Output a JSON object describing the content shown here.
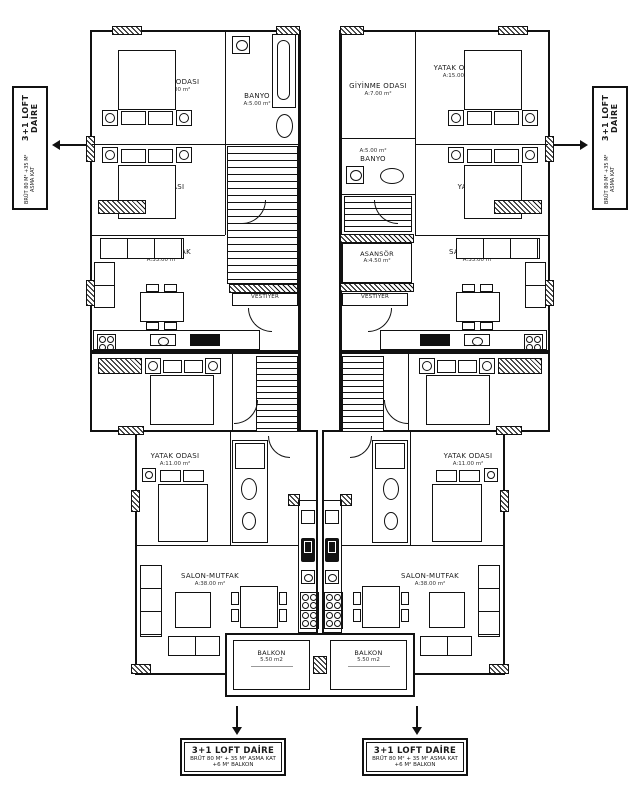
{
  "plan": {
    "upper_left": {
      "bedroom_a": {
        "name": "YATAK ODASI",
        "area": "A:15.00 m²"
      },
      "bedroom_b": {
        "name": "YATAK ODASI",
        "area": "A:14.00 m²"
      },
      "bathroom": {
        "name": "BANYO",
        "area": "A:5.00 m²"
      },
      "living": {
        "name": "SALON-MUTFAK",
        "area": "A:33.00 m²"
      },
      "vestibule": "VESTIYER"
    },
    "upper_right": {
      "dressing": {
        "name": "GİYİNME ODASI",
        "area": "A:7.00 m²"
      },
      "bedroom_a": {
        "name": "YATAK ODASI",
        "area": "A:15.00 m²"
      },
      "bathroom": {
        "name": "BANYO",
        "area": "A:5.00 m²"
      },
      "bedroom_b": {
        "name": "YATAK ODASI",
        "area": "A:14.00 m²"
      },
      "living": {
        "name": "SALON-MUTFAK",
        "area": "A:33.00 m²"
      },
      "vestibule": "VESTİYER",
      "elevator": {
        "name": "ASANSÖR",
        "area": "A:4.50 m²"
      }
    },
    "lower_left": {
      "bedroom_c": {
        "name": "YATAK ODASI",
        "area": "A:18.00 m²"
      },
      "bedroom_d": {
        "name": "YATAK ODASI",
        "area": "A:11.00 m²"
      },
      "living": {
        "name": "SALON-MUTFAK",
        "area": "A:38.00 m²"
      },
      "balcony": {
        "name": "BALKON",
        "area": "5.50 m2"
      }
    },
    "lower_right": {
      "bedroom_c": {
        "name": "YATAK ODASI",
        "area": "A:18.00 m²"
      },
      "bedroom_d": {
        "name": "YATAK ODASI",
        "area": "A:11.00 m²"
      },
      "living": {
        "name": "SALON-MUTFAK",
        "area": "A:38.00 m²"
      },
      "balcony": {
        "name": "BALKON",
        "area": "5.50 m2"
      }
    },
    "annotations": {
      "left_tag": {
        "title": "3+1 LOFT DAİRE",
        "subtitle": "BRÜT 80 M² +35 M² ASMA KAT"
      },
      "right_tag": {
        "title": "3+1 LOFT DAİRE",
        "subtitle": "BRÜT 80 M² +35 M² ASMA KAT"
      },
      "bottom_left_tag": {
        "title": "3+1 LOFT DAİRE",
        "line2": "BRÜT 80 M² + 35 M² ASMA KAT",
        "line3": "+6 M² BALKON"
      },
      "bottom_right_tag": {
        "title": "3+1 LOFT DAİRE",
        "line2": "BRÜT 80 M² + 35 M² ASMA KAT",
        "line3": "+6 M² BALKON"
      }
    },
    "colors": {
      "line": "#111111",
      "background": "#ffffff"
    }
  }
}
